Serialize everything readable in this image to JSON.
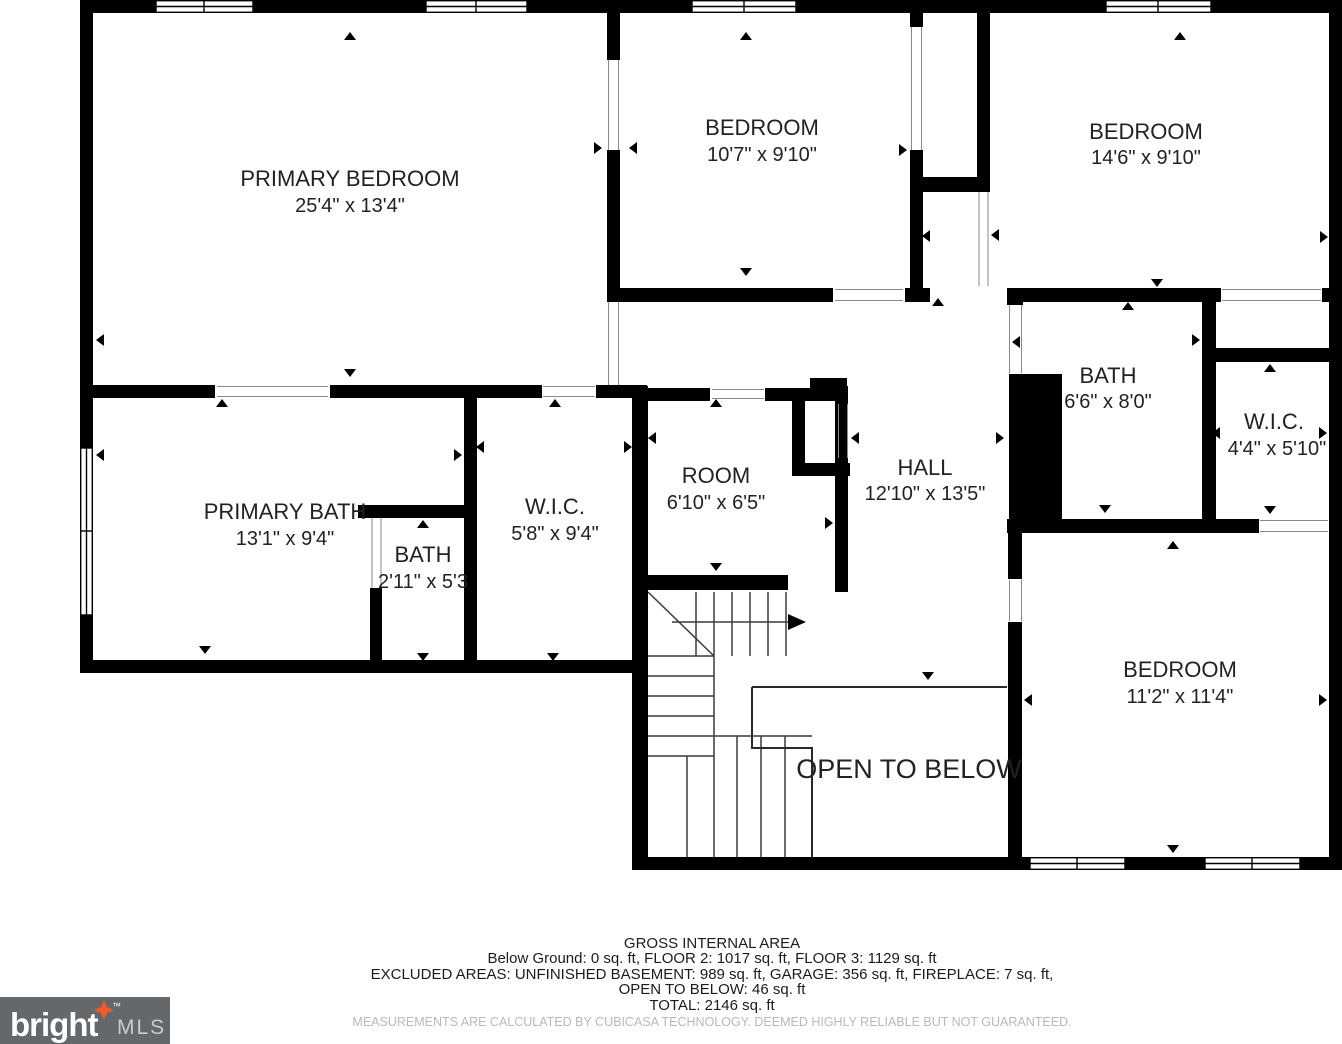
{
  "plan": {
    "rooms": {
      "primary_bedroom": {
        "name": "PRIMARY BEDROOM",
        "dims": "25'4\" x 13'4\""
      },
      "bedroom_top": {
        "name": "BEDROOM",
        "dims": "10'7\" x 9'10\""
      },
      "bedroom_right": {
        "name": "BEDROOM",
        "dims": "14'6\" x 9'10\""
      },
      "bath_upper": {
        "name": "BATH",
        "dims": "6'6\" x 8'0\""
      },
      "wic_right": {
        "name": "W.I.C.",
        "dims": "4'4\" x 5'10\""
      },
      "primary_bath": {
        "name": "PRIMARY BATH",
        "dims": "13'1\" x 9'4\""
      },
      "bath_small": {
        "name": "BATH",
        "dims": "2'11\" x 5'3"
      },
      "wic_left": {
        "name": "W.I.C.",
        "dims": "5'8\" x 9'4\""
      },
      "room": {
        "name": "ROOM",
        "dims": "6'10\" x 6'5\""
      },
      "hall": {
        "name": "HALL",
        "dims": "12'10\" x 13'5\""
      },
      "bedroom_bottom": {
        "name": "BEDROOM",
        "dims": "11'2\" x 11'4\""
      },
      "open_to_below": {
        "name": "OPEN TO BELOW"
      }
    }
  },
  "footer": {
    "gross_title": "GROSS INTERNAL AREA",
    "floors": "Below Ground: 0 sq. ft, FLOOR 2: 1017 sq. ft, FLOOR 3: 1129 sq. ft",
    "excluded": "EXCLUDED AREAS: UNFINISHED BASEMENT: 989 sq. ft, GARAGE: 356 sq. ft, FIREPLACE: 7 sq. ft,",
    "open_below": "OPEN TO BELOW: 46 sq. ft",
    "total": "TOTAL: 2146 sq. ft",
    "disclaimer": "MEASUREMENTS ARE CALCULATED BY CUBICASA TECHNOLOGY. DEEMED HIGHLY RELIABLE BUT NOT GUARANTEED."
  },
  "logo": {
    "brand": "bright",
    "suffix": "MLS",
    "tm": "™"
  },
  "colors": {
    "wall": "#000000",
    "stair_line": "#3a3a3a",
    "frame_line": "#8a8a8a",
    "disclaimer_gray": "#b9b9b9",
    "logo_bg": "#64686b",
    "logo_text": "#ffffff",
    "logo_mls": "#c9cccd",
    "star_orange": "#f15b2a"
  }
}
